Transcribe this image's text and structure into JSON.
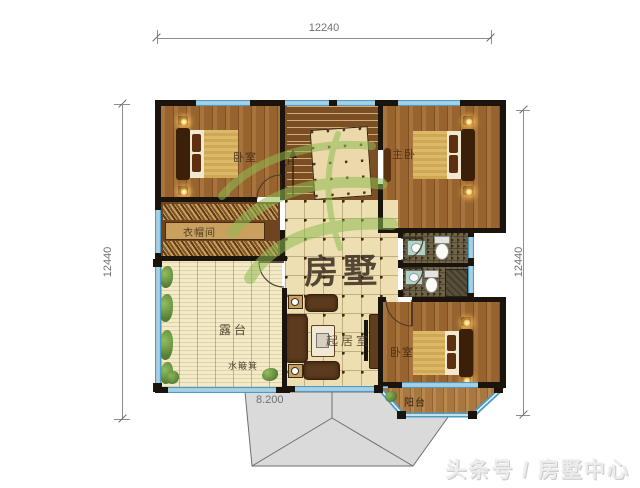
{
  "plan": {
    "dims": {
      "top": "12240",
      "left": "12440",
      "right": "12440",
      "level": "8.200"
    },
    "rooms": {
      "bedroom_tl": "卧室",
      "master_bedroom": "主卧",
      "cloakroom": "衣帽间",
      "terrace": "露台",
      "living_room": "起居室",
      "bedroom_br": "卧室",
      "balcony": "阳台",
      "water_drain": "水簸箕",
      "stair_up": "上"
    }
  },
  "watermark": {
    "brand": "房墅",
    "footer": "头条号 / 房墅中心"
  },
  "colors": {
    "wall": "#1a140d",
    "window_blue": "#4d9cc6",
    "wood": "#9a6a3a",
    "tile": "#eddfb2",
    "bath_tile": "#6f6449",
    "roof_gray": "#dadada",
    "watermark_green": "#8fbc53"
  }
}
